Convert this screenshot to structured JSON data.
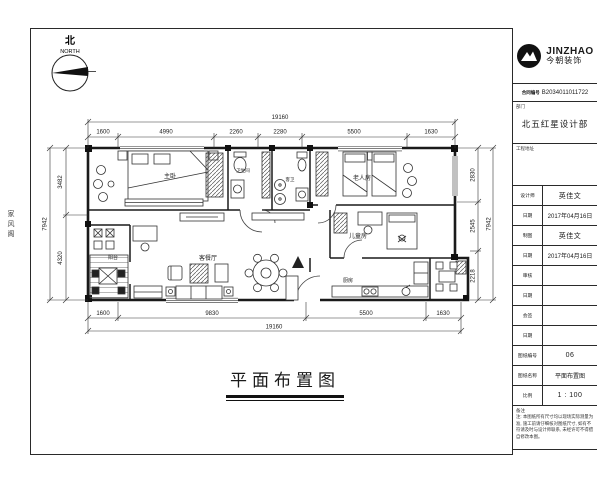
{
  "sheet": {
    "north_label": "北",
    "north_sub": "NORTH",
    "side_label": "家风阁",
    "title": "平面布置图"
  },
  "title_block": {
    "brand": {
      "en": "JINZHAO",
      "cn": "今朝装饰"
    },
    "contract": {
      "label": "合同编号",
      "value": "B2034011011722"
    },
    "department": {
      "label": "部门",
      "value": "北五红星设计部"
    },
    "address": {
      "label": "工程地址",
      "value": ""
    },
    "rows": [
      {
        "label": "设计师",
        "value": "英佳文"
      },
      {
        "label": "日期",
        "value": "2017年04月16日"
      },
      {
        "label": "制图",
        "value": "英佳文"
      },
      {
        "label": "日期",
        "value": "2017年04月16日"
      },
      {
        "label": "审核",
        "value": ""
      },
      {
        "label": "日期",
        "value": ""
      },
      {
        "label": "会签",
        "value": ""
      },
      {
        "label": "日期",
        "value": ""
      },
      {
        "label": "图纸编号",
        "value": "06"
      },
      {
        "label": "图纸名称",
        "value": "平面布置图"
      },
      {
        "label": "比例",
        "value": "1 : 100"
      }
    ],
    "remark": {
      "label": "备注",
      "text": "注: 本图纸所有尺寸均以现场实际测量为准, 施工前请仔细核对图纸尺寸, 如有不符请及时与设计师联系, 未经许可不得擅自修改本图。"
    }
  },
  "plan": {
    "rooms": [
      {
        "name": "主卧"
      },
      {
        "name": "卫生间"
      },
      {
        "name": "客卫"
      },
      {
        "name": "老人房"
      },
      {
        "name": "儿童房"
      },
      {
        "name": "厨房"
      },
      {
        "name": "客餐厅"
      },
      {
        "name": "阳台"
      }
    ],
    "dims": {
      "top_overall": "19160",
      "top": [
        "1600",
        "4990",
        "2260",
        "2280",
        "5500",
        "1630"
      ],
      "bottom": [
        "1600",
        "9830",
        "5500",
        "1630"
      ],
      "bottom_overall": "19160",
      "left": [
        "3482",
        "4320"
      ],
      "left_overall": "7942",
      "right": [
        "2830",
        "2545",
        "2218"
      ],
      "right_overall": "7942"
    }
  }
}
